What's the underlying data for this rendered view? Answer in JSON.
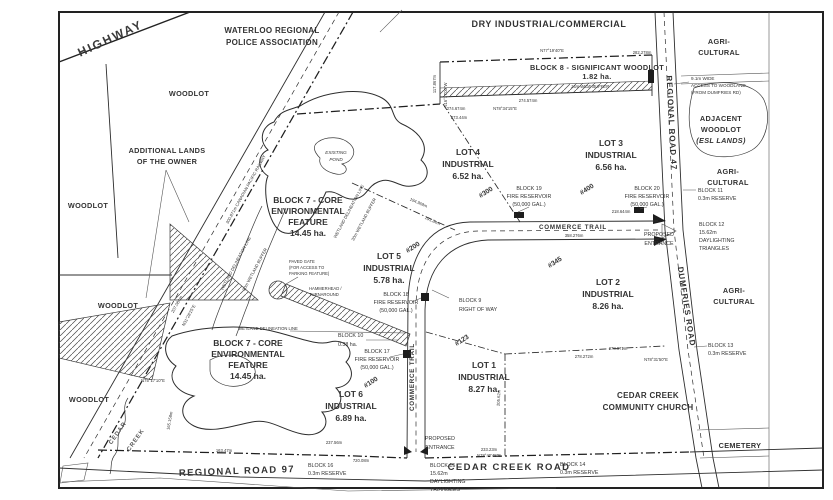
{
  "zones": {
    "police": [
      "WATERLOO REGIONAL",
      "POLICE ASSOCIATION"
    ],
    "dry": "DRY INDUSTRIAL/COMMERCIAL",
    "agri": [
      "AGRI-",
      "CULTURAL"
    ],
    "woodlot": "WOODLOT",
    "additional": [
      "ADDITIONAL LANDS",
      "OF THE OWNER"
    ],
    "adjacent": [
      "ADJACENT",
      "WOODLOT",
      "(ESL LANDS)"
    ],
    "cemetery": "CEMETERY",
    "church": [
      "CEDAR CREEK",
      "COMMUNITY CHURCH"
    ]
  },
  "lots": [
    {
      "name": "LOT 1",
      "zoning": "INDUSTRIAL",
      "area": "8.27 ha."
    },
    {
      "name": "LOT 2",
      "zoning": "INDUSTRIAL",
      "area": "8.26 ha."
    },
    {
      "name": "LOT 3",
      "zoning": "INDUSTRIAL",
      "area": "6.56 ha."
    },
    {
      "name": "LOT 4",
      "zoning": "INDUSTRIAL",
      "area": "6.52 ha."
    },
    {
      "name": "LOT 5",
      "zoning": "INDUSTRIAL",
      "area": "5.78 ha."
    },
    {
      "name": "LOT 6",
      "zoning": "INDUSTRIAL",
      "area": "6.89 ha."
    }
  ],
  "blocks": {
    "b7": [
      "BLOCK 7 - CORE",
      "ENVIRONMENTAL",
      "FEATURE",
      "14.45 ha."
    ],
    "b8": [
      "BLOCK 8 - SIGNIFICANT WOODLOT",
      "1.82 ha."
    ],
    "b9": [
      "BLOCK 9",
      "RIGHT OF WAY"
    ],
    "b10": [
      "BLOCK 10",
      "0.38 ha."
    ],
    "b11": [
      "BLOCK 11",
      "0.3m RESERVE"
    ],
    "b12": [
      "BLOCK 12",
      "15.62m",
      "DAYLIGHTING",
      "TRIANGLES"
    ],
    "b13": [
      "BLOCK 13",
      "0.3m RESERVE"
    ],
    "b14": [
      "BLOCK 14",
      "0.3m RESERVE"
    ],
    "b15": [
      "BLOCK 15",
      "15.62m",
      "DAYLIGHTING",
      "TRIANGLES"
    ],
    "b16": [
      "BLOCK 16",
      "0.3m RESERVE"
    ],
    "b17": [
      "BLOCK 17",
      "FIRE RESERVOIR",
      "(50,000 GAL.)"
    ],
    "b18": [
      "BLOCK 18",
      "FIRE RESERVOIR",
      "(50,000 GAL.)"
    ],
    "b19": [
      "BLOCK 19",
      "FIRE RESERVOIR",
      "(50,000 GAL.)"
    ],
    "b20": [
      "BLOCK 20",
      "FIRE RESERVOIR",
      "(50,000 GAL.)"
    ]
  },
  "roads": {
    "highway": "HIGHWAY",
    "railway": "300.871m    CANADIAN PACIFIC RAILWAY",
    "commerce": "COMMERCE TRAIL",
    "cedar_creek_road": "CEDAR CREEK ROAD",
    "regional97": "REGIONAL ROAD 97",
    "regional47": "REGIONAL ROAD 47",
    "dumfries": "DUMFRIES ROAD",
    "creek": [
      "CEDAR",
      "CREEK"
    ]
  },
  "addresses": [
    "#100",
    "#123",
    "#200",
    "#300",
    "#345",
    "#400"
  ],
  "notes": {
    "entrance": [
      "PROPOSED",
      "ENTRANCE"
    ],
    "pond": [
      "EXISTING",
      "POND"
    ],
    "hammerhead": [
      "HAMMERHEAD /",
      "TURNAROUND"
    ],
    "gate": [
      "PAVED GATE",
      "(FOR ACCESS TO",
      "PARKING FEATURE)"
    ],
    "access": [
      "9.1m WIDE",
      "ACCESS TO WOODLAND",
      "(FROM DUMFRIES RD)"
    ],
    "buffer15": "15m WIDE BUFFER",
    "wetland_line": "WETLAND DELINEATION LINE",
    "wetland_buffer": "30m WETLAND BUFFER"
  },
  "dims": {
    "n_brg": "N77°19'40\"E",
    "n_len": "282.278m",
    "l4_len": "274.674m",
    "l4_brg": "N78°34'15\"E",
    "l4_len2": "273.44m",
    "b8_w": "117.867m",
    "b8_w_brg": "N16°17'00\"W",
    "b8_s": "274.574m",
    "ct_len": "358.276m",
    "ct_len2": "218.644m",
    "rr97_1": "163.47m",
    "rr97_2": "237.56m",
    "rr97_3": "720.08m",
    "ccr_len": "233.23m",
    "ccr_brg": "N78°40'45\"E",
    "ch_1": "278.971m",
    "ch_2": "278.272m",
    "ch_brg": "N78°31'50\"E",
    "ch_w": "205.62m",
    "rail_len": "207.084m",
    "rail_brg": "N31°28'25\"E",
    "w_len": "165.158m",
    "w_brg": "N75°17'10\"E",
    "l45_a": "194.969m",
    "l45_b": "191.84m"
  },
  "colors": {
    "ink": "#333333",
    "paper": "#ffffff"
  }
}
